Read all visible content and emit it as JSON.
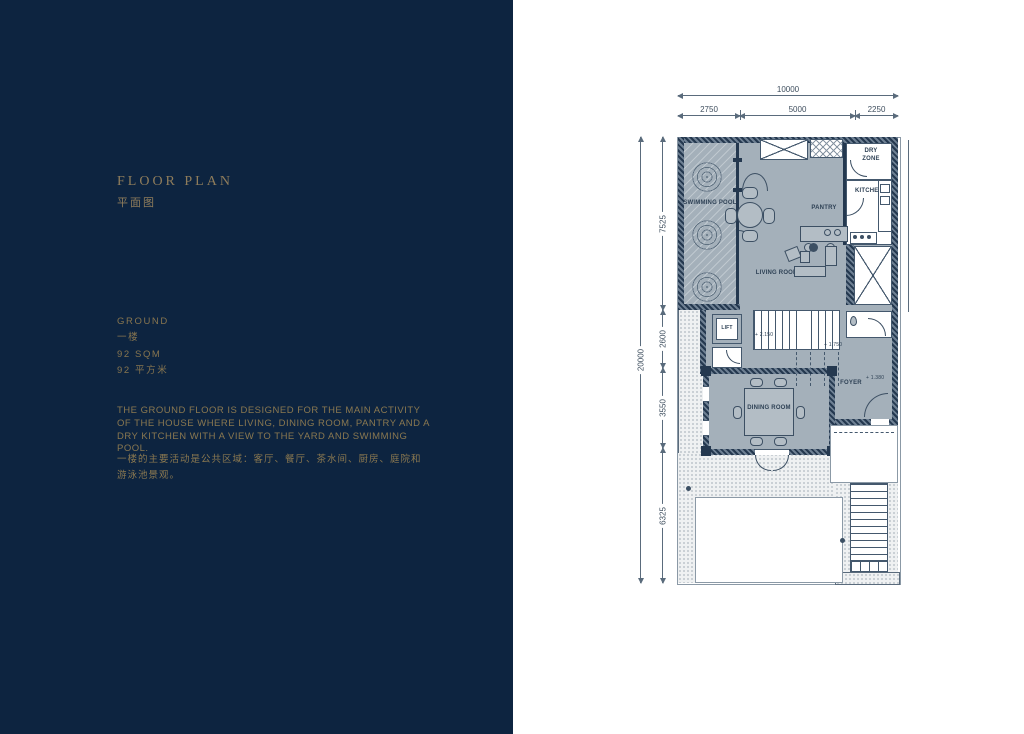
{
  "panel": {
    "bg_color": "#0d2440",
    "accent_color": "#8e7c5b",
    "title_en": "FLOOR PLAN",
    "title_zh": "平面图",
    "level_en": "GROUND",
    "level_zh": "一楼",
    "area_en": "92 SQM",
    "area_zh": "92 平方米",
    "desc_en": "THE GROUND FLOOR IS DESIGNED FOR THE MAIN ACTIVITY OF THE HOUSE WHERE LIVING, DINING ROOM, PANTRY AND A DRY KITCHEN WITH A VIEW TO THE YARD AND SWIMMING POOL.",
    "desc_zh": "一楼的主要活动是公共区域：客厅、餐厅、茶水间、厨房、庭院和游泳池景观。"
  },
  "plan": {
    "wall_color": "#24384f",
    "room_fill_color": "#a4b0ba",
    "dimensions": {
      "top_total": "10000",
      "top_segments": [
        "2750",
        "5000",
        "2250"
      ],
      "left_total": "20000",
      "left_segments": [
        "7525",
        "2600",
        "3550",
        "6325"
      ]
    },
    "rooms": {
      "swimming_pool": "SWIMMING POOL",
      "pantry": "PANTRY",
      "kitchen": "KITCHEN",
      "dry_zone": "DRY ZONE",
      "living_room": "LIVING ROOM",
      "lift": "LIFT",
      "dining_room": "DINING ROOM",
      "foyer": "FOYER"
    },
    "levels": {
      "stair_low": "+ 2.150",
      "stair_mid": "+ 1.750",
      "foyer": "+ 1.380"
    }
  }
}
